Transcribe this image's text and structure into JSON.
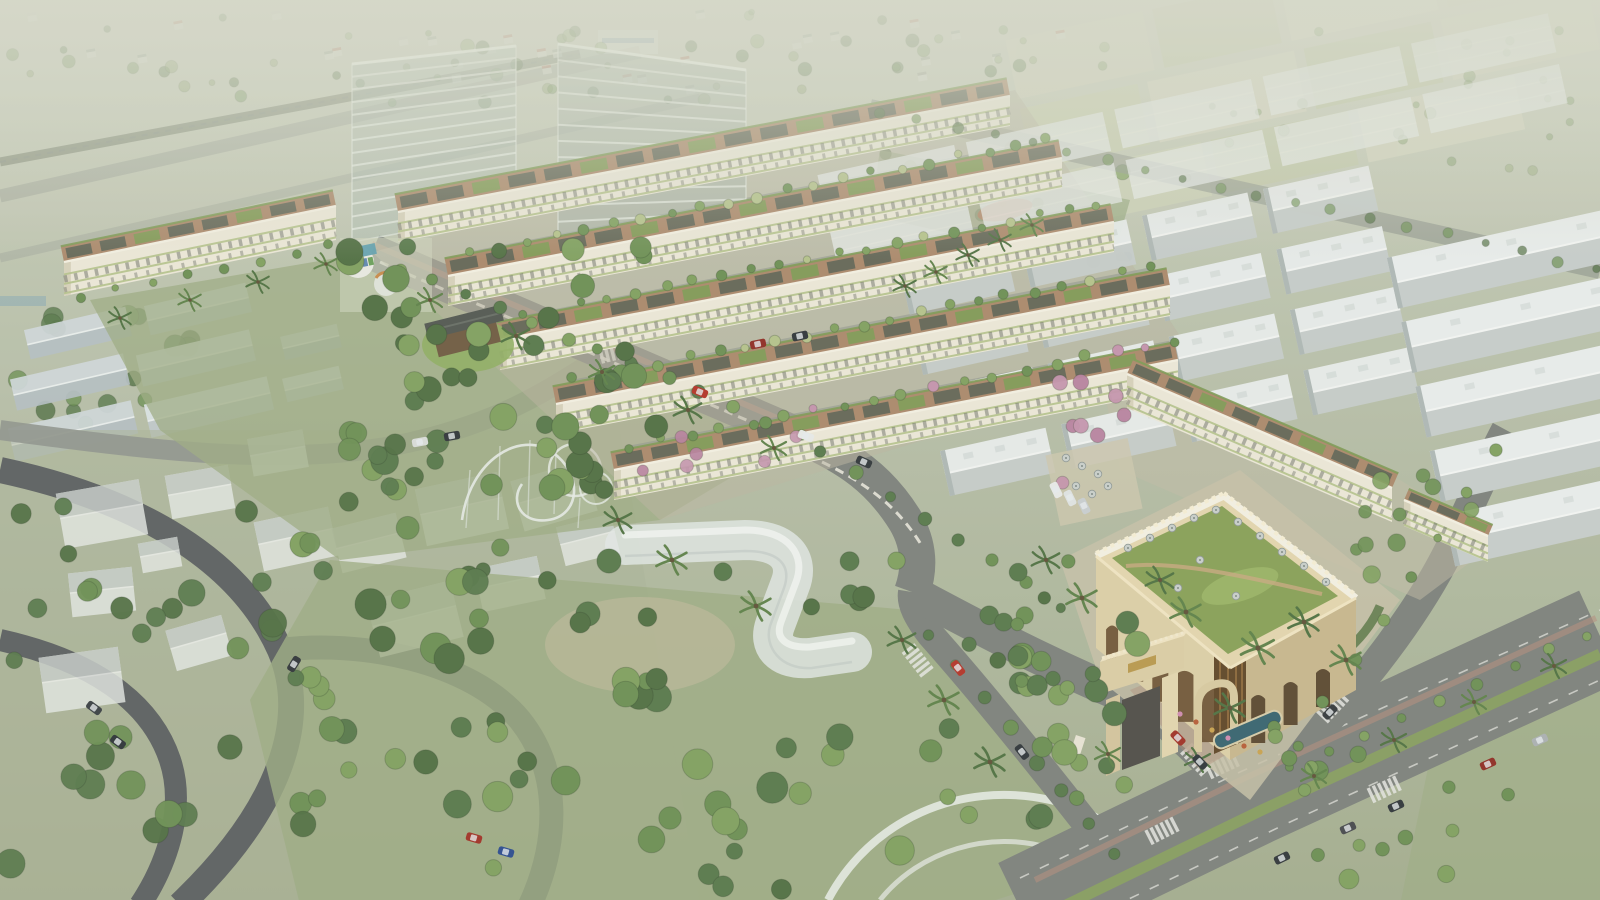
{
  "meta": {
    "kind": "aerial-architectural-rendering",
    "subject": "residential masterplan with townhouse rows, clubhouse with arched gate, parks and industrial warehouses",
    "visible_text": []
  },
  "palette": {
    "base_top": "#ccd0bf",
    "base_mid": "#b6bea7",
    "base_bot": "#a3ad8e",
    "haze": "#d7dacb",
    "road": "#7c817b",
    "road_dark": "#5b5f60",
    "road_light": "#8f948d",
    "brick": "#b58d7b",
    "median_green": "#87a05c",
    "park": "#9cab82",
    "park_dark": "#8ba073",
    "ground_estate": "#bab4a0",
    "facade": "#ece8d8",
    "facade_shade": "#d7d1bb",
    "parapet": "#f4f0e2",
    "planter": "#b4c28a",
    "window": "#686c63",
    "deck": "#ab886a",
    "panel": "#5c6355",
    "roof_green": "#7d9a54",
    "shed_light": "#e9edec",
    "shed_shade": "#c6cdcb",
    "shed_ridge": "#f4f6f4",
    "shed_end": "#aeb7b5",
    "shed_vent": "#d9dfdd",
    "beige": "#dccfa6",
    "beige_light": "#e9dcb8",
    "beige_shade": "#c7b68c",
    "arch": "#6a5132",
    "arch_dark": "#54412a",
    "arch_brown": "#8a6336",
    "glass_line": "#eef2ea",
    "tree1": "#57784a",
    "tree2": "#6b8f52",
    "tree3": "#7fa05e",
    "tree4": "#4f6e41",
    "tree_pale": "#8aa36b",
    "pink1": "#c493ad",
    "pink2": "#b77f9e",
    "white": "#e9ece7",
    "pool": "#35626e",
    "gold": "#b8984c",
    "ghost": "#e4e8e4",
    "ghost_roof": "#c9d0cc",
    "flower_red": "#b65c35",
    "flower_gold": "#c9a24e",
    "flower_pink": "#cf8ab0"
  },
  "scene": {
    "rows": [
      {
        "x1": 398,
        "y1": 212,
        "x2": 1010,
        "y2": 96,
        "fh": 30,
        "depth": 18
      },
      {
        "x1": 448,
        "y1": 276,
        "x2": 1062,
        "y2": 158,
        "fh": 30,
        "depth": 18
      },
      {
        "x1": 500,
        "y1": 340,
        "x2": 1114,
        "y2": 222,
        "fh": 30,
        "depth": 18
      },
      {
        "x1": 556,
        "y1": 404,
        "x2": 1170,
        "y2": 286,
        "fh": 30,
        "depth": 18
      },
      {
        "x1": 614,
        "y1": 470,
        "x2": 1178,
        "y2": 360,
        "fh": 30,
        "depth": 18
      }
    ],
    "blocks": [
      {
        "x1": 64,
        "y1": 262,
        "x2": 336,
        "y2": 206,
        "fh": 34,
        "depth": 16
      },
      {
        "x1": 1127,
        "y1": 374,
        "x2": 1392,
        "y2": 488,
        "fh": 34,
        "depth": 16
      },
      {
        "x1": 1404,
        "y1": 500,
        "x2": 1488,
        "y2": 536,
        "fh": 26,
        "depth": 12
      }
    ],
    "towers": [
      {
        "pts": [
          [
            352,
            64
          ],
          [
            516,
            46
          ],
          [
            516,
            212
          ],
          [
            352,
            242
          ]
        ],
        "floors": 14,
        "fill": "rgba(176,190,180,0.5)"
      },
      {
        "pts": [
          [
            558,
            44
          ],
          [
            746,
            70
          ],
          [
            746,
            238
          ],
          [
            558,
            254
          ]
        ],
        "floors": 13,
        "fill": "rgba(166,180,170,0.52)"
      }
    ],
    "warehouses": [
      {
        "rot": -12.5,
        "px": 1200,
        "py": 330,
        "ox": 860,
        "oy": 96,
        "cols": 5,
        "rows": 2,
        "w": 140,
        "h": 40,
        "gx": 12,
        "gy": 12,
        "style": "flat",
        "op": 0.72
      },
      {
        "rot": -12.5,
        "px": 1200,
        "py": 330,
        "ox": 920,
        "oy": 206,
        "cols": 4,
        "rows": 4,
        "w": 108,
        "h": 46,
        "gx": 16,
        "gy": 16,
        "style": "gable",
        "op": 0.97
      },
      {
        "rot": -12.5,
        "px": 1200,
        "py": 330,
        "ox": 1398,
        "oy": 300,
        "cols": 1,
        "rows": 5,
        "w": 240,
        "h": 52,
        "gx": 0,
        "gy": 14,
        "style": "gable",
        "op": 1
      }
    ],
    "field_patches": [
      [
        1020,
        -20,
        140,
        60,
        "#d2d5bd"
      ],
      [
        1170,
        -20,
        120,
        60,
        "#c3caa8"
      ],
      [
        1300,
        -20,
        150,
        60,
        "#dcdcc6"
      ],
      [
        1460,
        -20,
        130,
        60,
        "#c9cfae"
      ],
      [
        1020,
        50,
        120,
        62,
        "#c9cfae"
      ],
      [
        1150,
        50,
        150,
        62,
        "#d8d9c2"
      ],
      [
        1310,
        50,
        130,
        62,
        "#bfc7a4"
      ],
      [
        1450,
        50,
        150,
        62,
        "#d2d5bd"
      ],
      [
        1040,
        120,
        150,
        55,
        "#cdd2b6"
      ],
      [
        1200,
        120,
        140,
        55,
        "#c2c9a6"
      ],
      [
        1350,
        120,
        160,
        55,
        "#d6d8c0"
      ]
    ],
    "distant_houses": {
      "x": 0,
      "y": 10,
      "w": 1080,
      "h": 80,
      "n": 30,
      "seed": 11
    },
    "left_sheds": [
      [
        26,
        318,
        104,
        30,
        -13
      ],
      [
        146,
        294,
        104,
        30,
        -13
      ],
      [
        12,
        366,
        116,
        32,
        -13
      ],
      [
        138,
        342,
        116,
        32,
        -13
      ],
      [
        10,
        414,
        126,
        34,
        -13
      ],
      [
        146,
        390,
        126,
        34,
        -13
      ],
      [
        282,
        330,
        58,
        24,
        -13
      ],
      [
        284,
        372,
        58,
        24,
        -13
      ]
    ],
    "ghost_houses": [
      [
        60,
        486,
        84,
        56,
        -10
      ],
      [
        168,
        470,
        64,
        44,
        -10
      ],
      [
        258,
        514,
        76,
        50,
        -12
      ],
      [
        70,
        570,
        64,
        44,
        -6
      ],
      [
        42,
        652,
        80,
        56,
        -8
      ],
      [
        170,
        622,
        58,
        42,
        -16
      ],
      [
        336,
        520,
        66,
        46,
        -14
      ],
      [
        420,
        480,
        84,
        58,
        -12
      ],
      [
        516,
        470,
        76,
        52,
        -16
      ],
      [
        372,
        590,
        86,
        58,
        -14
      ],
      [
        478,
        562,
        64,
        44,
        -12
      ],
      [
        560,
        520,
        56,
        40,
        -14
      ],
      [
        250,
        434,
        56,
        38,
        -10
      ],
      [
        140,
        540,
        40,
        30,
        -10
      ]
    ],
    "tree_clusters": [
      {
        "layer": "bg",
        "x": 0,
        "y": 12,
        "w": 1040,
        "h": 92,
        "n": 60,
        "rmin": 3,
        "rmax": 7,
        "colors": [
          "tree_pale",
          "tree2",
          "tree4"
        ],
        "op": 0.5,
        "seed": 3
      },
      {
        "layer": "bg",
        "x": 1100,
        "y": 30,
        "w": 480,
        "h": 150,
        "n": 28,
        "rmin": 3,
        "rmax": 6,
        "colors": [
          "tree_pale",
          "tree2"
        ],
        "op": 0.45,
        "seed": 4
      },
      {
        "layer": "bg",
        "x": 0,
        "y": 315,
        "w": 210,
        "h": 110,
        "n": 16,
        "rmin": 6,
        "rmax": 11,
        "colors": [
          "tree1",
          "tree2",
          "tree4"
        ],
        "op": 0.8,
        "seed": 5
      },
      {
        "layer": "bg",
        "x": 880,
        "y": 148,
        "w": 250,
        "h": 115,
        "n": 20,
        "rmin": 4,
        "rmax": 8,
        "colors": [
          "tree2",
          "tree3",
          "tree4"
        ],
        "op": 0.85,
        "seed": 6
      },
      {
        "layer": "main",
        "x": 346,
        "y": 246,
        "w": 360,
        "h": 245,
        "n": 48,
        "rmin": 7,
        "rmax": 14,
        "colors": [
          "tree1",
          "tree2",
          "tree3",
          "tree4"
        ],
        "op": 1,
        "seed": 7
      },
      {
        "layer": "main",
        "x": 300,
        "y": 540,
        "w": 610,
        "h": 350,
        "n": 62,
        "rmin": 8,
        "rmax": 16,
        "colors": [
          "tree1",
          "tree2",
          "tree3",
          "tree4"
        ],
        "op": 1,
        "seed": 8
      },
      {
        "layer": "main",
        "x": 898,
        "y": 618,
        "w": 250,
        "h": 210,
        "n": 24,
        "rmin": 7,
        "rmax": 13,
        "colors": [
          "tree1",
          "tree2",
          "tree3"
        ],
        "op": 1,
        "seed": 9
      },
      {
        "layer": "main",
        "x": 0,
        "y": 445,
        "w": 310,
        "h": 420,
        "n": 30,
        "rmin": 8,
        "rmax": 15,
        "colors": [
          "tree1",
          "tree2",
          "tree4"
        ],
        "op": 0.95,
        "seed": 10
      },
      {
        "layer": "main",
        "x": 300,
        "y": 430,
        "w": 330,
        "h": 190,
        "n": 16,
        "rmin": 7,
        "rmax": 13,
        "colors": [
          "tree1",
          "tree2",
          "tree4"
        ],
        "op": 0.95,
        "seed": 12
      },
      {
        "layer": "main",
        "x": 1262,
        "y": 726,
        "w": 330,
        "h": 170,
        "n": 16,
        "rmin": 6,
        "rmax": 10,
        "colors": [
          "tree2",
          "tree3"
        ],
        "op": 1,
        "seed": 13
      },
      {
        "layer": "main",
        "x": 962,
        "y": 560,
        "w": 140,
        "h": 130,
        "n": 14,
        "rmin": 6,
        "rmax": 11,
        "colors": [
          "tree1",
          "tree2",
          "tree4"
        ],
        "op": 1,
        "seed": 14
      },
      {
        "layer": "main",
        "x": 1352,
        "y": 470,
        "w": 200,
        "h": 110,
        "n": 10,
        "rmin": 5,
        "rmax": 9,
        "colors": [
          "tree2",
          "tree3"
        ],
        "op": 0.9,
        "seed": 15
      },
      {
        "layer": "main",
        "x": 1040,
        "y": 380,
        "w": 120,
        "h": 110,
        "n": 8,
        "rmin": 5,
        "rmax": 8,
        "colors": [
          "pink1",
          "pink2"
        ],
        "op": 0.95,
        "seed": 16
      },
      {
        "layer": "main",
        "x": 620,
        "y": 425,
        "w": 260,
        "h": 60,
        "n": 6,
        "rmin": 5,
        "rmax": 7,
        "colors": [
          "pink1",
          "pink2"
        ],
        "op": 0.9,
        "seed": 17
      }
    ],
    "tree_lines": [
      {
        "x1": 470,
        "y1": 252,
        "x2": 1046,
        "y2": 140,
        "n": 21,
        "r": 4.5,
        "colors": [
          "tree2",
          "tree3",
          "planter"
        ],
        "op": 1,
        "seed": 21
      },
      {
        "x1": 522,
        "y1": 316,
        "x2": 1098,
        "y2": 204,
        "n": 21,
        "r": 4.5,
        "colors": [
          "tree2",
          "tree3",
          "planter"
        ],
        "op": 1,
        "seed": 22
      },
      {
        "x1": 574,
        "y1": 380,
        "x2": 1150,
        "y2": 268,
        "n": 21,
        "r": 4.5,
        "colors": [
          "tree2",
          "tree3",
          "planter"
        ],
        "op": 1,
        "seed": 23
      },
      {
        "x1": 630,
        "y1": 446,
        "x2": 1176,
        "y2": 340,
        "n": 19,
        "r": 4.5,
        "colors": [
          "tree2",
          "tree3",
          "pink1"
        ],
        "op": 1,
        "seed": 24
      },
      {
        "x1": 400,
        "y1": 268,
        "x2": 800,
        "y2": 434,
        "n": 13,
        "r": 5.5,
        "colors": [
          "tree1",
          "tree2",
          "tree3"
        ],
        "op": 1,
        "seed": 25
      },
      {
        "x1": 820,
        "y1": 450,
        "x2": 1060,
        "y2": 606,
        "n": 8,
        "r": 5.5,
        "colors": [
          "tree1",
          "tree2"
        ],
        "op": 1,
        "seed": 26
      },
      {
        "x1": 1290,
        "y1": 770,
        "x2": 1588,
        "y2": 634,
        "n": 9,
        "r": 5,
        "colors": [
          "tree2",
          "tree3"
        ],
        "op": 1,
        "seed": 27
      },
      {
        "x1": 880,
        "y1": 112,
        "x2": 1596,
        "y2": 268,
        "n": 20,
        "r": 4.5,
        "colors": [
          "tree2",
          "tree4"
        ],
        "op": 0.7,
        "seed": 28
      },
      {
        "x1": 1116,
        "y1": 856,
        "x2": 930,
        "y2": 636,
        "n": 8,
        "r": 6,
        "colors": [
          "tree1",
          "tree2"
        ],
        "op": 1,
        "seed": 29
      },
      {
        "x1": 1296,
        "y1": 744,
        "x2": 1496,
        "y2": 452,
        "n": 8,
        "r": 5,
        "colors": [
          "tree2",
          "tree3"
        ],
        "op": 1,
        "seed": 30
      },
      {
        "x1": 80,
        "y1": 296,
        "x2": 330,
        "y2": 246,
        "n": 8,
        "r": 4,
        "colors": [
          "tree2",
          "tree3"
        ],
        "op": 1,
        "seed": 31
      }
    ],
    "palms": [
      [
        430,
        300,
        1
      ],
      [
        516,
        336,
        1.1
      ],
      [
        602,
        372,
        1
      ],
      [
        688,
        410,
        1.1
      ],
      [
        774,
        448,
        1
      ],
      [
        120,
        318,
        0.9
      ],
      [
        190,
        300,
        0.9
      ],
      [
        258,
        282,
        0.9
      ],
      [
        326,
        264,
        0.9
      ],
      [
        902,
        640,
        1.1
      ],
      [
        944,
        700,
        1.2
      ],
      [
        990,
        762,
        1.2
      ],
      [
        1082,
        598,
        1.2
      ],
      [
        1046,
        560,
        1.1
      ],
      [
        1186,
        612,
        1.2
      ],
      [
        1160,
        580,
        1.1
      ],
      [
        1258,
        648,
        1.3
      ],
      [
        1304,
        622,
        1.2
      ],
      [
        1346,
        660,
        1.2
      ],
      [
        1230,
        708,
        1.2
      ],
      [
        1108,
        754,
        1
      ],
      [
        1198,
        760,
        1
      ],
      [
        1314,
        776,
        1
      ],
      [
        1394,
        740,
        1
      ],
      [
        1474,
        702,
        1
      ],
      [
        1554,
        666,
        1
      ],
      [
        672,
        560,
        1.2
      ],
      [
        618,
        520,
        1.1
      ],
      [
        756,
        606,
        1.2
      ],
      [
        1000,
        240,
        0.9
      ],
      [
        1032,
        225,
        0.9
      ],
      [
        968,
        255,
        0.9
      ],
      [
        936,
        272,
        0.9
      ],
      [
        905,
        286,
        0.9
      ]
    ],
    "cars": [
      [
        700,
        392,
        22,
        "#b33226"
      ],
      [
        806,
        436,
        22,
        "#e8eae8"
      ],
      [
        864,
        462,
        24,
        "#2f3539"
      ],
      [
        758,
        344,
        -12,
        "#8f2b22"
      ],
      [
        800,
        336,
        -12,
        "#2e3438"
      ],
      [
        958,
        668,
        52,
        "#b33226"
      ],
      [
        1022,
        752,
        52,
        "#2e3438"
      ],
      [
        1178,
        738,
        46,
        "#a03024"
      ],
      [
        1200,
        762,
        46,
        "#2e3438"
      ],
      [
        1396,
        806,
        -24,
        "#2e3438"
      ],
      [
        1348,
        828,
        -24,
        "#45484c"
      ],
      [
        1488,
        764,
        -24,
        "#8f2b22"
      ],
      [
        1540,
        740,
        -24,
        "#aab0b2"
      ],
      [
        1282,
        858,
        -26,
        "#2f3438"
      ],
      [
        1330,
        712,
        -46,
        "#33383c"
      ],
      [
        118,
        742,
        36,
        "#2c3236"
      ],
      [
        94,
        708,
        36,
        "#3a3f43"
      ],
      [
        294,
        664,
        -58,
        "#2f3438"
      ],
      [
        506,
        852,
        16,
        "#2a4b8f"
      ],
      [
        474,
        838,
        16,
        "#a03024"
      ],
      [
        420,
        442,
        -10,
        "#d9dcd9"
      ],
      [
        452,
        436,
        -10,
        "#2f3438"
      ],
      [
        1056,
        490,
        64,
        "#e8eae8"
      ],
      [
        1070,
        498,
        64,
        "#dfe3e2"
      ],
      [
        1084,
        506,
        64,
        "#c9ced0"
      ]
    ],
    "zebras": [
      [
        1208,
        772,
        -25
      ],
      [
        1370,
        796,
        -25
      ],
      [
        1186,
        748,
        48
      ],
      [
        1148,
        838,
        -27
      ],
      [
        1322,
        718,
        -47
      ],
      [
        600,
        356,
        -14
      ],
      [
        908,
        648,
        52
      ]
    ],
    "umbrellas": [
      [
        1128,
        548
      ],
      [
        1150,
        538
      ],
      [
        1172,
        528
      ],
      [
        1194,
        518
      ],
      [
        1216,
        510
      ],
      [
        1238,
        522
      ],
      [
        1260,
        536
      ],
      [
        1282,
        552
      ],
      [
        1304,
        566
      ],
      [
        1326,
        582
      ],
      [
        1200,
        560
      ],
      [
        1236,
        596
      ],
      [
        1178,
        588
      ],
      [
        1066,
        458
      ],
      [
        1082,
        466
      ],
      [
        1098,
        474
      ],
      [
        1076,
        486
      ],
      [
        1092,
        494
      ],
      [
        1108,
        486
      ]
    ],
    "flowers": [
      [
        1196,
        722
      ],
      [
        1212,
        730
      ],
      [
        1228,
        738
      ],
      [
        1244,
        746
      ],
      [
        1260,
        752
      ],
      [
        1180,
        714
      ]
    ]
  }
}
